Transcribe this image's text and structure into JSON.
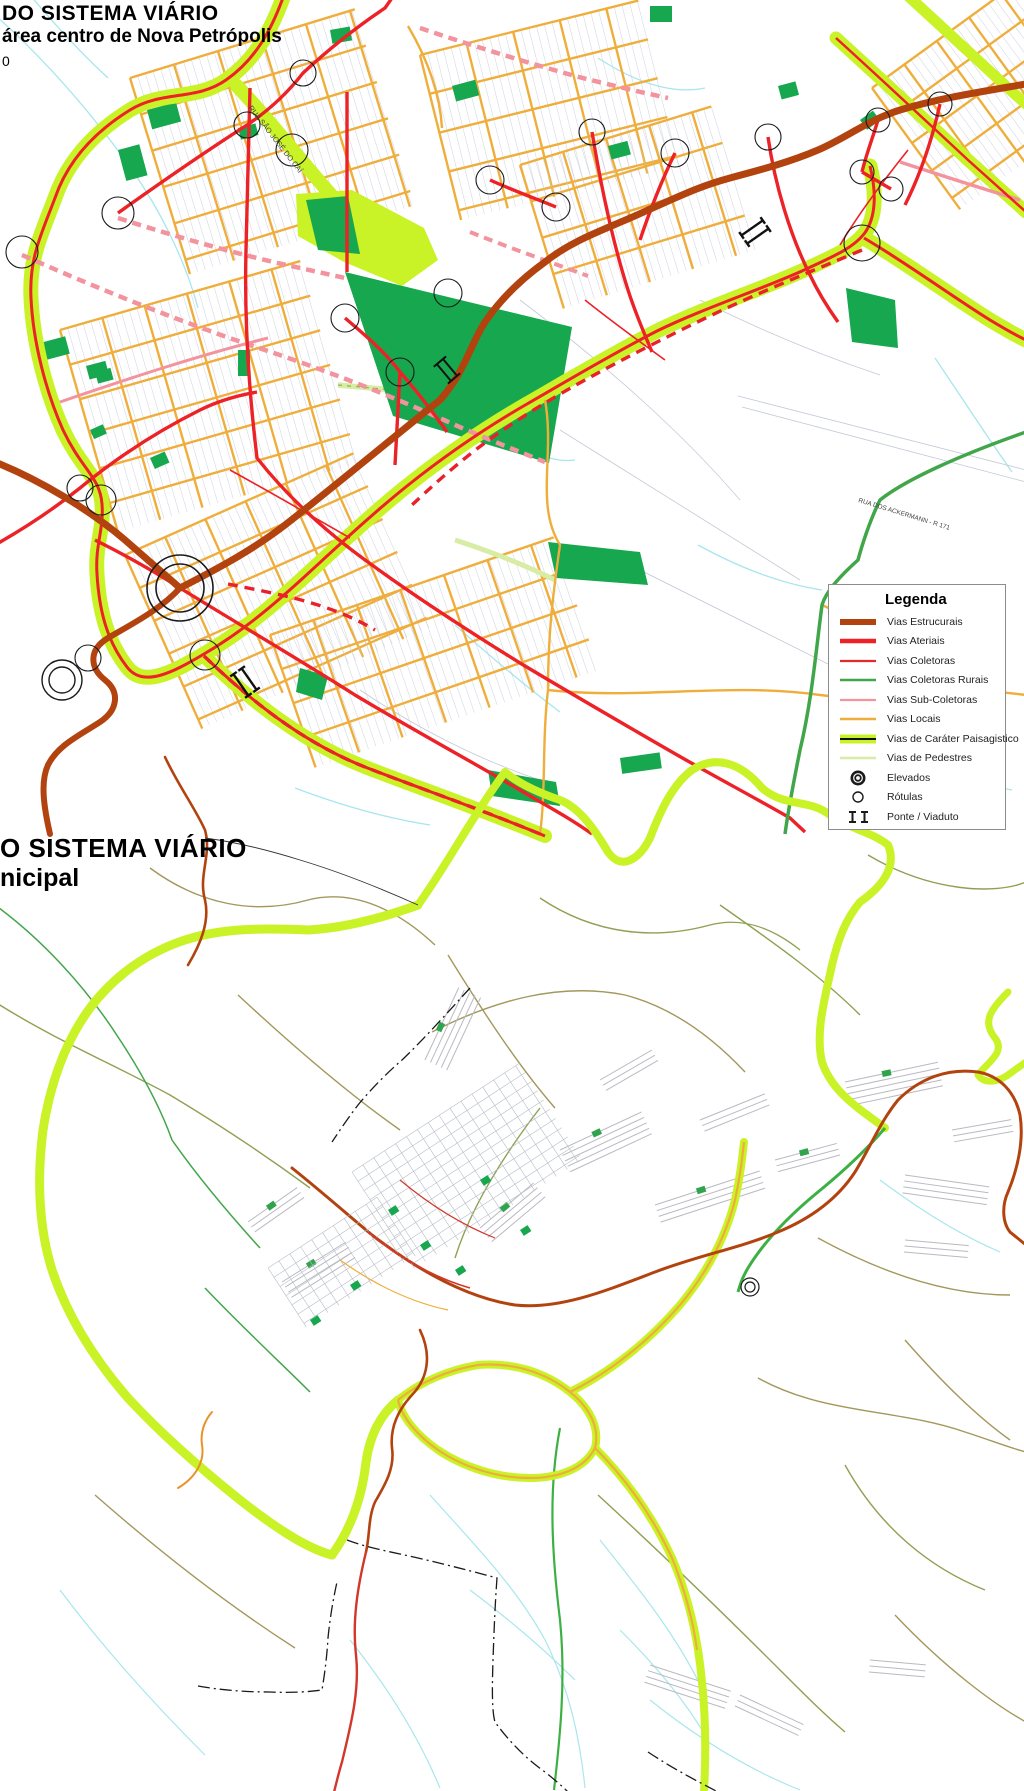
{
  "map1": {
    "title_line1": "DO SISTEMA VIÁRIO",
    "title_line2": "área centro de Nova Petrópolis",
    "scale_fragment": "0"
  },
  "map2": {
    "title_line1": "O SISTEMA VIÁRIO",
    "title_line2": "nicipal"
  },
  "legend": {
    "title": "Legenda",
    "items": [
      {
        "label": "Vias Estrucurais",
        "type": "estruturais",
        "color": "#B2430F"
      },
      {
        "label": "Vias Ateriais",
        "type": "arteriais",
        "color": "#EC2227"
      },
      {
        "label": "Vias Coletoras",
        "type": "coletoras",
        "color": "#E32A2A"
      },
      {
        "label": "Vias Coletoras Rurais",
        "type": "coletoras-rurais",
        "color": "#41A649"
      },
      {
        "label": "Vias Sub-Coletoras",
        "type": "sub-coletoras",
        "color": "#F2939E"
      },
      {
        "label": "Vias Locais",
        "type": "locais",
        "color": "#EFAE3C"
      },
      {
        "label": "Vias de Caráter Paisagistico",
        "type": "paisagistico",
        "color": "#C9F227"
      },
      {
        "label": "Vias de Pedestres",
        "type": "pedestres",
        "color": "#D8ECA5"
      },
      {
        "label": "Elevados",
        "type": "elevados",
        "color": "#1a1a1a"
      },
      {
        "label": "Rótulas",
        "type": "rotulas",
        "color": "#1a1a1a"
      },
      {
        "label": "Ponte / Viaduto",
        "type": "ponte-viaduto",
        "color": "#1a1a1a"
      }
    ]
  },
  "street_labels": [
    {
      "text": "RUA SÃO JOSÉ DO CAÍ",
      "x": 248,
      "y": 108,
      "rotate": 52,
      "size": 7.5
    },
    {
      "text": "RUA DOS ACKERMANN - R 171",
      "x": 858,
      "y": 502,
      "rotate": 17,
      "size": 6.5
    }
  ],
  "colors": {
    "estruturais": "#B2430F",
    "arteriais": "#EC2227",
    "coletoras_rurais": "#41A649",
    "sub_coletoras": "#F2939E",
    "locais": "#EFAE3C",
    "paisagistico": "#C9F227",
    "pedestres": "#D8ECA5",
    "park_green": "#17A74E",
    "stream_cyan": "#A8E6EE",
    "rural_olive": "#A3985C",
    "boundary_black": "#1a1a1a"
  }
}
